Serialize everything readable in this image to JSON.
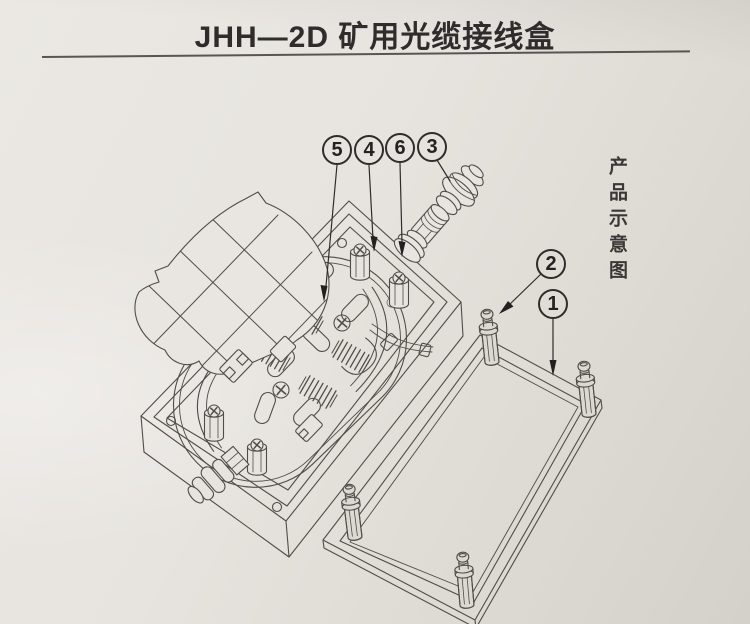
{
  "document": {
    "title": "JHH—2D 矿用光缆接线盒",
    "side_caption": "产品示意图"
  },
  "callouts": {
    "c1": {
      "label": "1"
    },
    "c2": {
      "label": "2"
    },
    "c3": {
      "label": "3"
    },
    "c4": {
      "label": "4"
    },
    "c5": {
      "label": "5"
    },
    "c6": {
      "label": "6"
    }
  },
  "colors": {
    "paper_light": "#eae7e2",
    "paper_dark": "#d4d0ca",
    "line": "#504d49",
    "ink": "#2e2d2b"
  }
}
